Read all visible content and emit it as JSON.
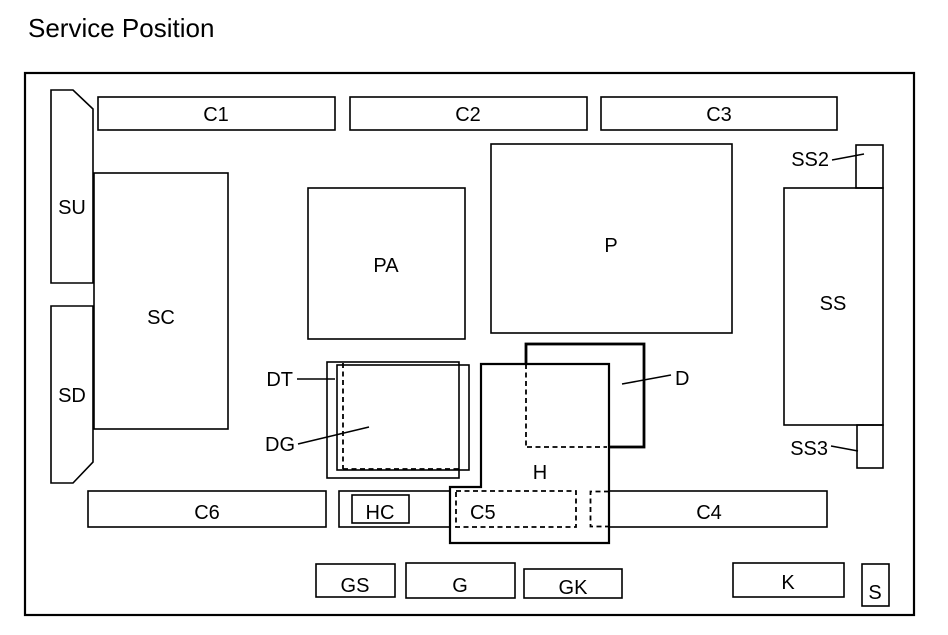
{
  "title": "Service Position",
  "colors": {
    "line": "#000000",
    "background": "#ffffff"
  },
  "components": {
    "c1": {
      "label": "C1"
    },
    "c2": {
      "label": "C2"
    },
    "c3": {
      "label": "C3"
    },
    "c4": {
      "label": "C4"
    },
    "c5": {
      "label": "C5"
    },
    "c6": {
      "label": "C6"
    },
    "su": {
      "label": "SU"
    },
    "sd": {
      "label": "SD"
    },
    "sc": {
      "label": "SC"
    },
    "pa": {
      "label": "PA"
    },
    "p": {
      "label": "P"
    },
    "ss": {
      "label": "SS"
    },
    "ss2": {
      "label": "SS2"
    },
    "ss3": {
      "label": "SS3"
    },
    "dt": {
      "label": "DT"
    },
    "dg": {
      "label": "DG"
    },
    "d": {
      "label": "D"
    },
    "h": {
      "label": "H"
    },
    "hc": {
      "label": "HC"
    },
    "gs": {
      "label": "GS"
    },
    "g": {
      "label": "G"
    },
    "gk": {
      "label": "GK"
    },
    "k": {
      "label": "K"
    },
    "s": {
      "label": "S"
    }
  }
}
